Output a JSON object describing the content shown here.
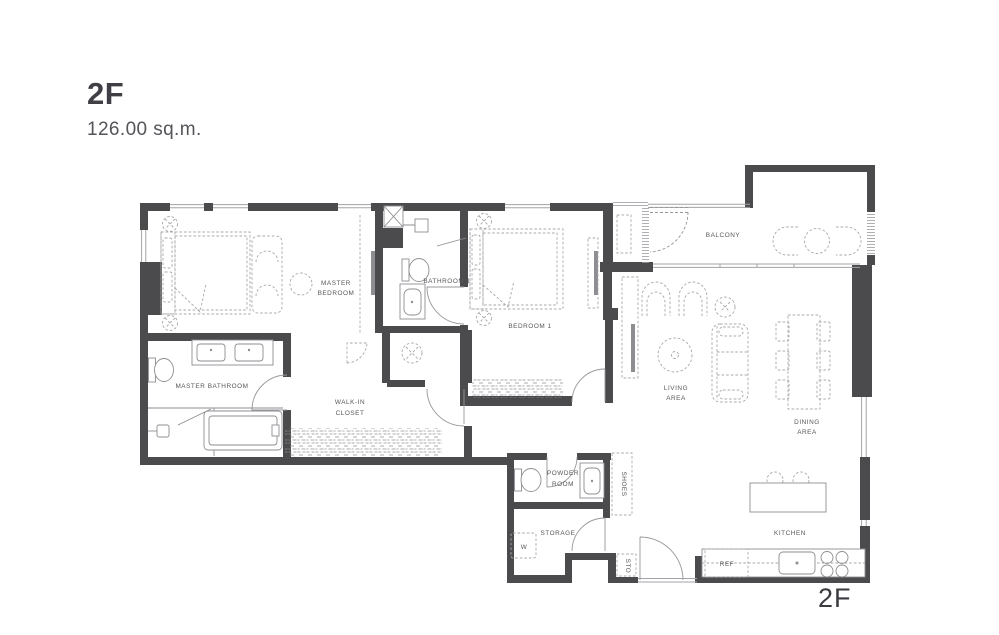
{
  "title": {
    "floor": "2F",
    "area": "126.00 sq.m."
  },
  "plan": {
    "floor_label": "2F"
  },
  "labels": {
    "master_bedroom": [
      "MASTER",
      "BEDROOM"
    ],
    "bathroom1": "BATHROOM 1",
    "bedroom1": "BEDROOM 1",
    "balcony": "BALCONY",
    "master_bathroom": "MASTER BATHROOM",
    "walk_in_closet": [
      "WALK-IN",
      "CLOSET"
    ],
    "living_area": [
      "LIVING",
      "AREA"
    ],
    "dining_area": [
      "DINING",
      "AREA"
    ],
    "powder_room": [
      "POWDER",
      "ROOM"
    ],
    "storage": "STORAGE",
    "shoes": "SHOES",
    "washer": "W",
    "sto": "STO",
    "kitchen": "KITCHEN",
    "ref": "REF"
  },
  "colors": {
    "wall": "#4b4b4e",
    "fixture_line": "#8e8e92",
    "furniture_line": "#a8a8ab",
    "label_text": "#57575b",
    "title_text": "#3f3f45"
  }
}
